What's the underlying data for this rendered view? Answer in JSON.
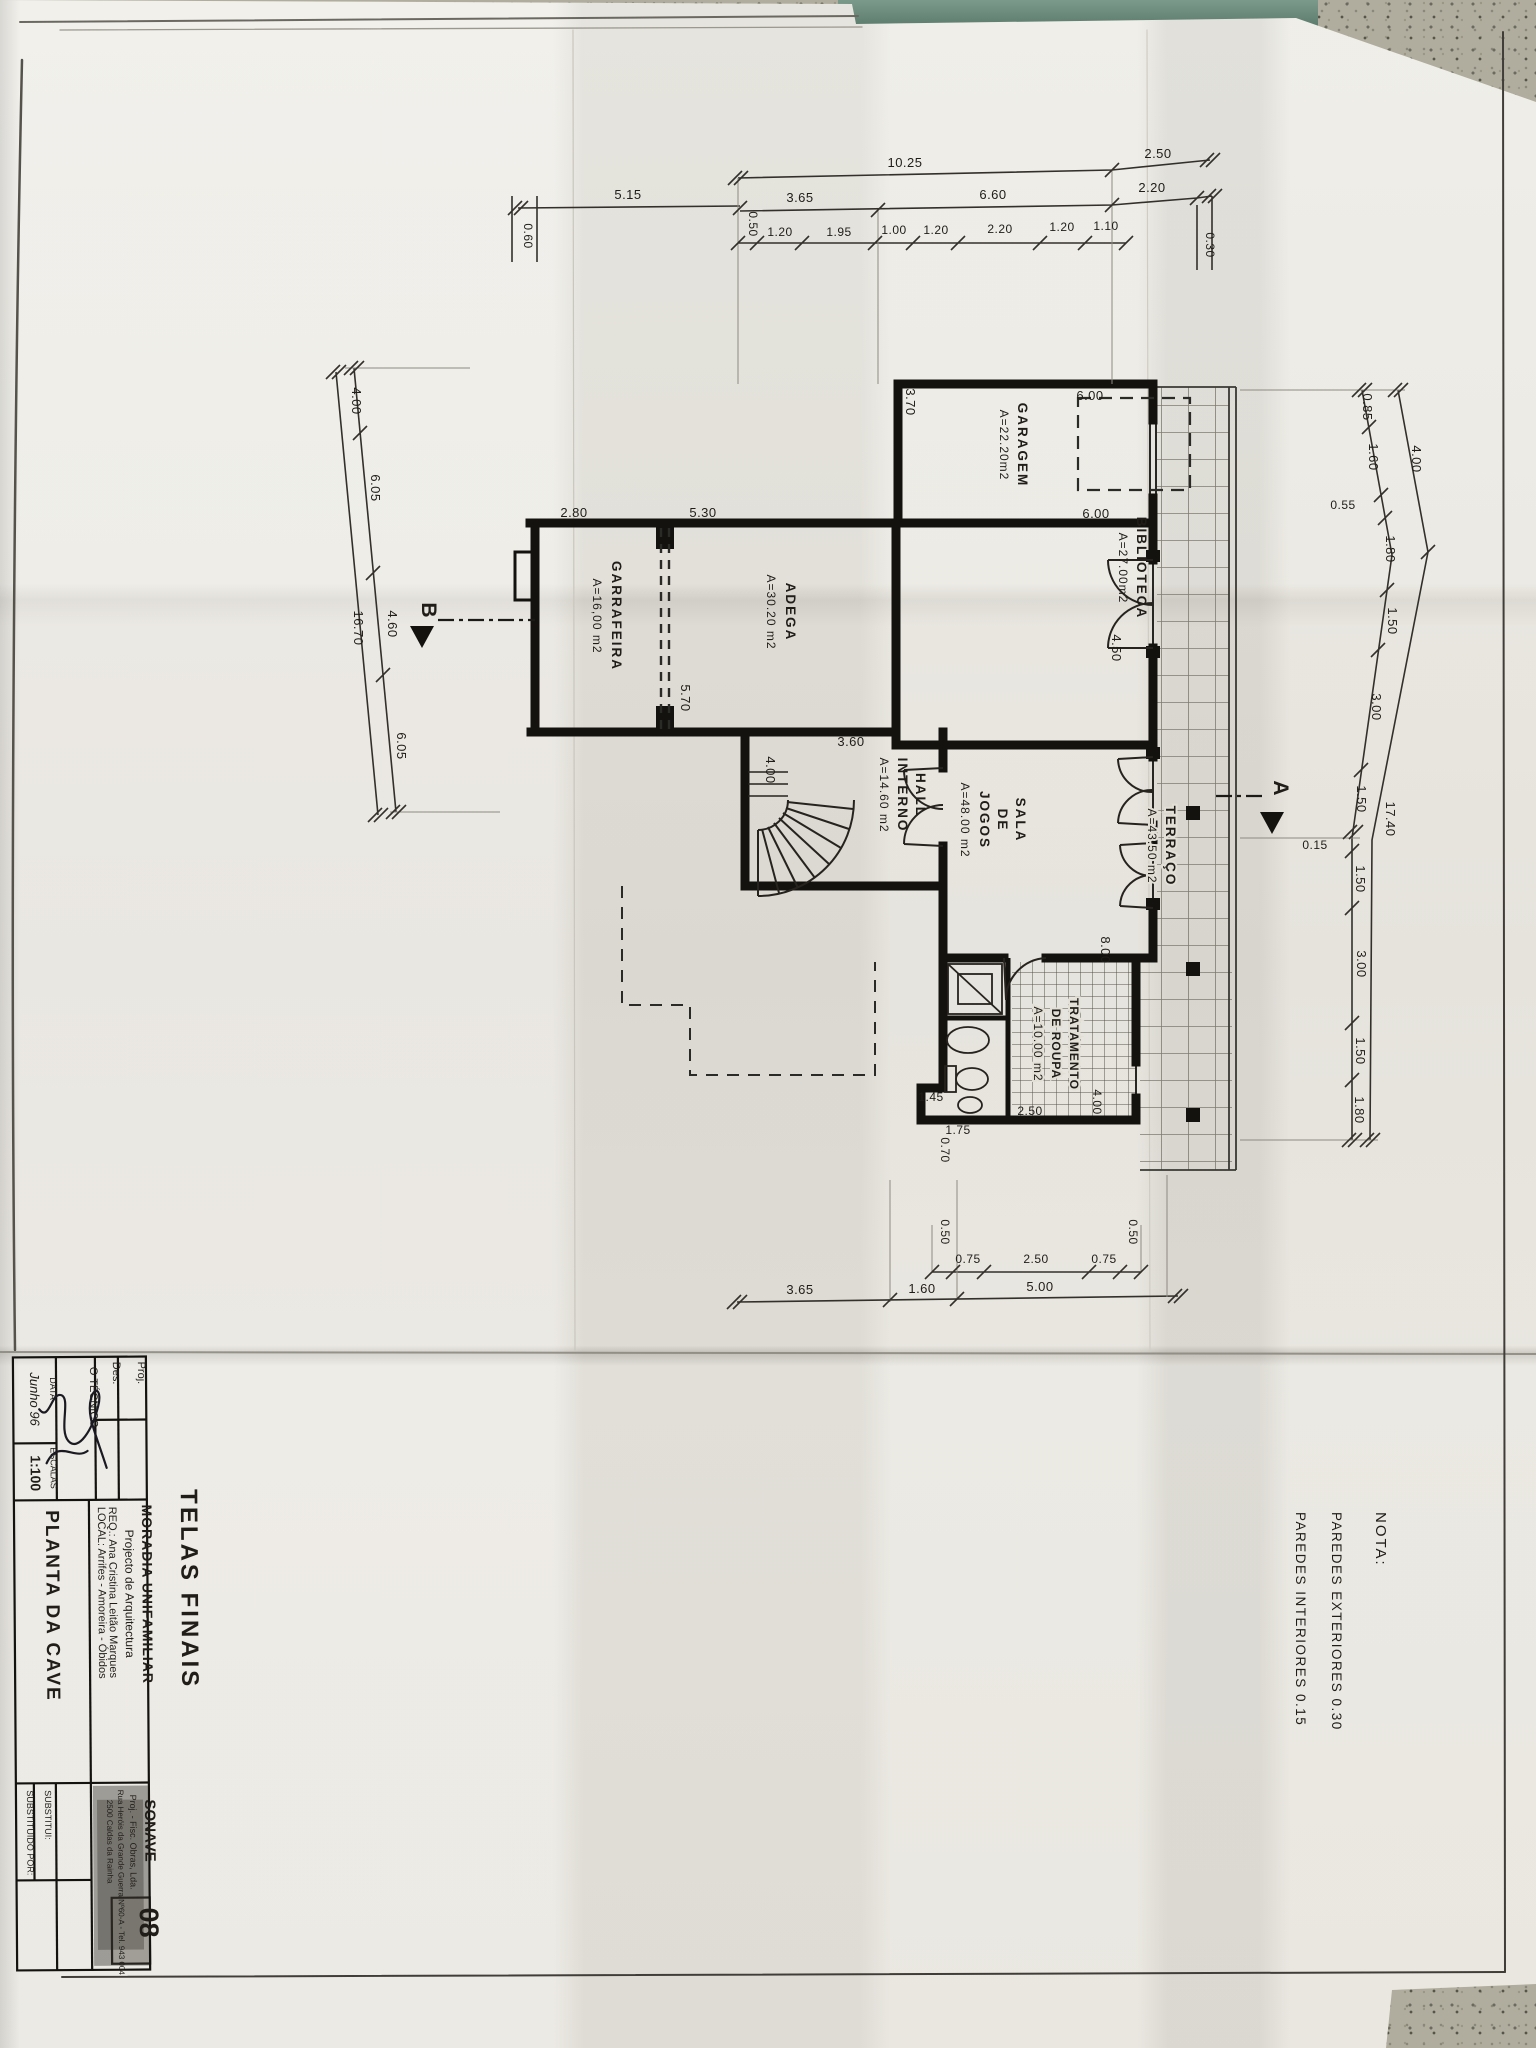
{
  "title_block": {
    "stamp": "TELAS FINAIS",
    "proj_label": "Proj.",
    "des_label": "Des.",
    "tecnico_label": "O TÉCNICO",
    "data_label": "DATA",
    "data_value": "Junho 96",
    "escalas_label": "ESCALAS",
    "escalas_value": "1:100",
    "project": "MORADIA UNIFAMILIAR",
    "subtitle": "Projecto de Arquitectura",
    "req": "REQ.: Ana Cristina Leitão Marques",
    "local": "LOCAL: Arrifes - Amoreira - Óbidos",
    "drawing_title": "PLANTA DA CAVE",
    "company_name": "SONAVE",
    "company_line1": "Proj. - Fisc. Obras, Lda.",
    "company_line2": "Rua Heróis da Grande Guerra Nº60-A - Tel. 943 004",
    "company_line3": "2500 Caldas da Rainha",
    "substitui": "SUBSTITUI:",
    "substituido": "SUBSTITUIDO POR:",
    "sheet_number": "08"
  },
  "nota": {
    "title": "NOTA:",
    "line1": "PAREDES EXTERIORES 0.30",
    "line2": "PAREDES INTERIORES 0.15"
  },
  "rooms": {
    "garagem": {
      "name": "GARAGEM",
      "area": "A=22.20m2"
    },
    "biblioteca": {
      "name": "BIBLIOTECA",
      "area": "A=27.00m2"
    },
    "adega": {
      "name": "ADEGA",
      "area": "A=30.20 m2"
    },
    "garrafeira": {
      "name": "GARRAFEIRA",
      "area": "A=16,00 m2"
    },
    "hall": {
      "l1": "HALL",
      "l2": "INTERNO",
      "area": "A=14.60 m2"
    },
    "sala": {
      "l1": "SALA",
      "l2": "DE",
      "l3": "JOGOS",
      "area": "A=48.00 m2"
    },
    "tratamento": {
      "l1": "TRATAMENTO",
      "l2": "DE ROUPA",
      "area": "A=10.00 m2"
    },
    "terraco": {
      "name": "TERRAÇO",
      "area": "A=43.50 m2"
    }
  },
  "dims": {
    "top_outer": [
      "10.25",
      "2.50"
    ],
    "top_mid": [
      "5.15",
      "3.65",
      "6.60",
      "2.20"
    ],
    "top_inner": [
      "0.50",
      "1.20",
      "1.95",
      "1.00",
      "1.20",
      "2.20",
      "1.20",
      "1.10"
    ],
    "top_side": [
      "0.60",
      "0.30"
    ],
    "right_inner": [
      "0.85",
      "1.60",
      "0.55",
      "1.80",
      "1.50",
      "3.00",
      "1.50",
      "0.15",
      "1.50",
      "3.00",
      "1.50",
      "1.80"
    ],
    "right_outer": [
      "4.00",
      "17.40"
    ],
    "left_inner": [
      "4.00",
      "6.05",
      "4.60",
      "6.05"
    ],
    "left_outer": [
      "16.70"
    ],
    "bottom_inner": [
      "0.50",
      "0.75",
      "2.50",
      "0.75",
      "0.50"
    ],
    "bottom_outer": [
      "3.65",
      "1.60",
      "5.00"
    ],
    "interior": {
      "garage_w": "6.00",
      "garage_d": "3.70",
      "biblioteca_w": "6.00",
      "biblioteca_door": "4.50",
      "garrafeira_w": "2.80",
      "adega_w": "5.30",
      "adega_d": "5.70",
      "hall_w": "3.60",
      "hall_d": "4.00",
      "sala_d": "8.00",
      "laundry_w": "2.50",
      "laundry_d": "4.00",
      "step1": "1.45",
      "step2": "1.75",
      "step3": "0.70"
    }
  },
  "sections": {
    "a": "A",
    "b": "B"
  },
  "colors": {
    "paper": "#e9e6df",
    "ink": "#1c1a17",
    "table": "#b3b0a2",
    "shelf": "#6f8f80"
  }
}
